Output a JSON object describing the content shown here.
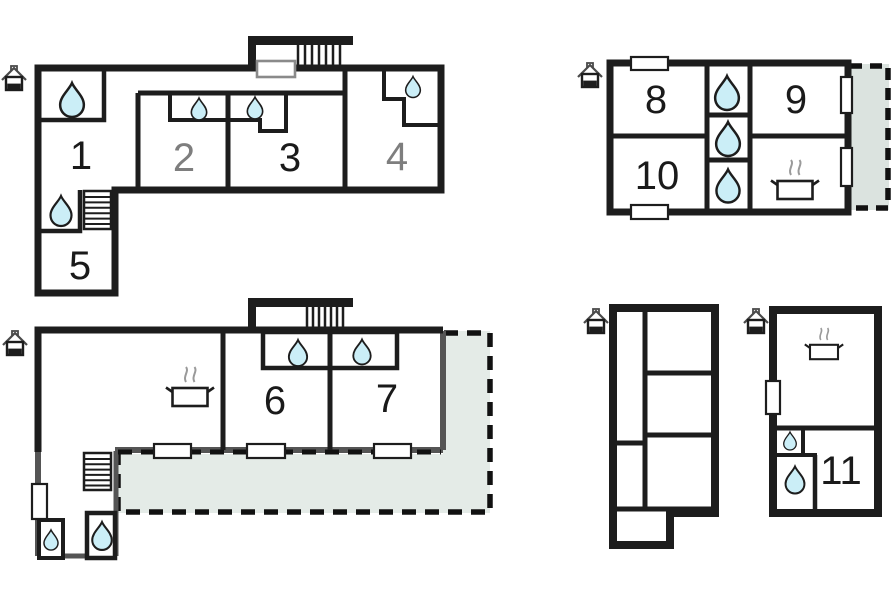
{
  "app": {
    "type": "floor-plan-diagram",
    "background": "#ffffff"
  },
  "colors": {
    "wall": "#1d1d1d",
    "wall_gray": "#555555",
    "drop_fill": "#cbeef7",
    "terrace_fill": "#e4ebe7",
    "terrace_fill_alt": "#dbe3df",
    "label": "#1a1a1a",
    "label_muted": "#7e7e7e",
    "steam": "#9a9a9a",
    "dash": "#111111"
  },
  "rooms": [
    {
      "label": "1",
      "muted": false
    },
    {
      "label": "2",
      "muted": true
    },
    {
      "label": "3",
      "muted": false
    },
    {
      "label": "4",
      "muted": true
    },
    {
      "label": "5",
      "muted": false
    },
    {
      "label": "6",
      "muted": false
    },
    {
      "label": "7",
      "muted": false
    },
    {
      "label": "8",
      "muted": false
    },
    {
      "label": "9",
      "muted": false
    },
    {
      "label": "10",
      "muted": false
    },
    {
      "label": "11",
      "muted": false
    }
  ],
  "icons": {
    "entrance": "house-entrance",
    "water_source": "water-drop",
    "kitchen": "cooking-pot",
    "stairs": "stairs",
    "terrace": "dashed-terrace-area"
  },
  "features": {
    "buildings": 5,
    "entrance_icons": 5,
    "water_drop_icons": 14,
    "cooking_pot_icons": 3,
    "staircases": 2,
    "balcony_stairs": 2,
    "terraces": 2,
    "windows": 9,
    "doors": 1
  }
}
